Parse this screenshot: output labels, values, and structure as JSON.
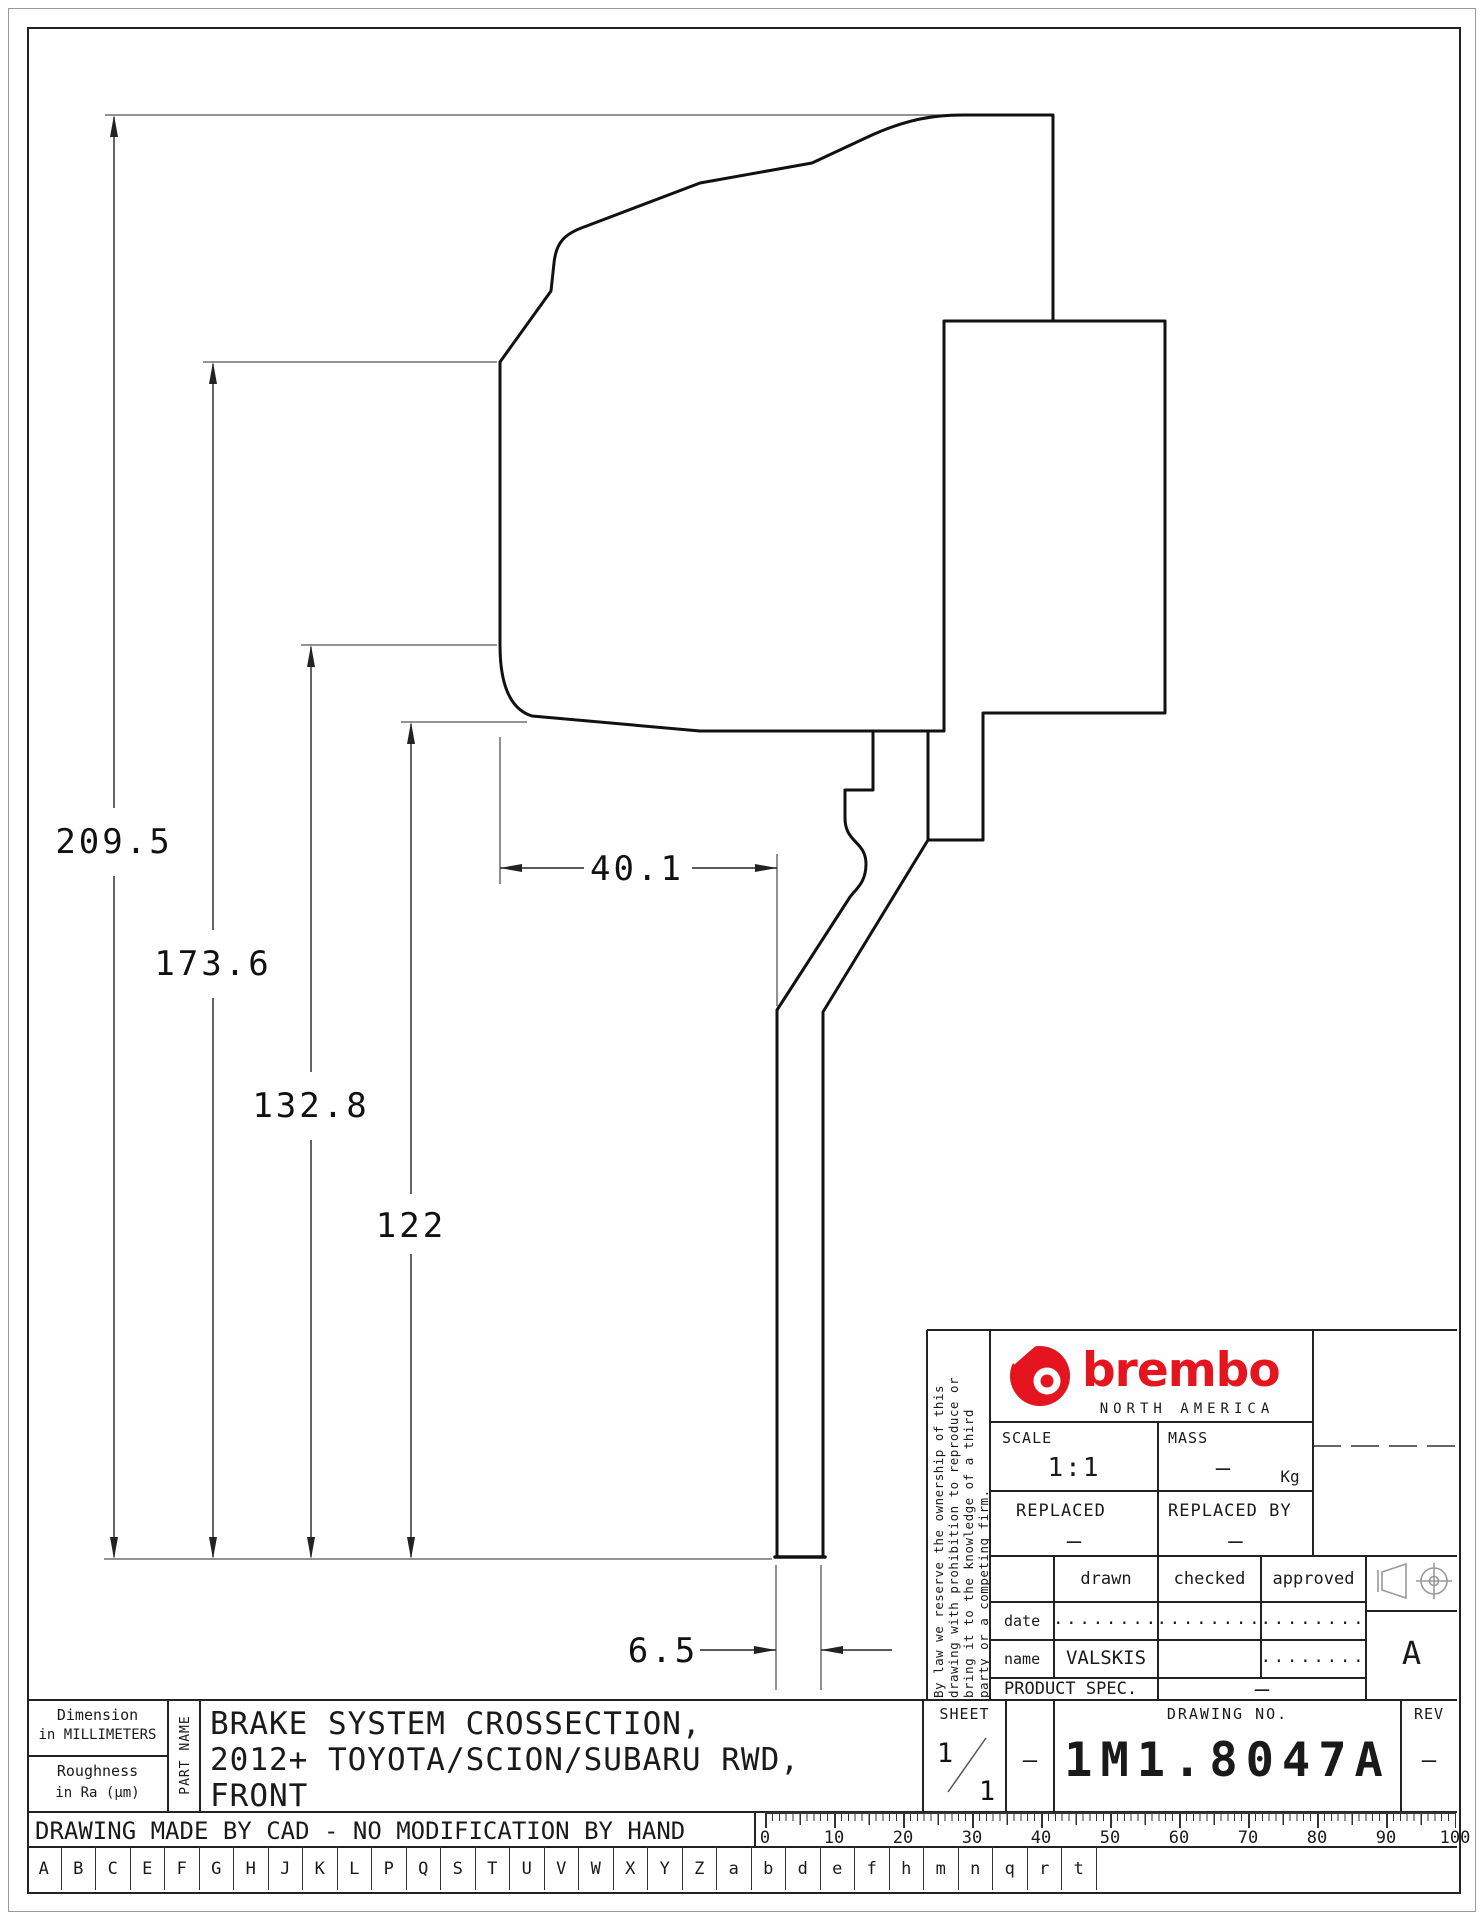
{
  "colors": {
    "line": "#1a1a1a",
    "thin": "#444444",
    "brand_red": "#e4151e"
  },
  "dimensions": {
    "radial": [
      {
        "label": "209.5"
      },
      {
        "label": "173.6"
      },
      {
        "label": "132.8"
      },
      {
        "label": "122"
      }
    ],
    "width": {
      "label": "40.1"
    },
    "thickness": {
      "label": "6.5"
    }
  },
  "title_block": {
    "ownership_lines": [
      "By law we reserve the ownership of this",
      "drawing with prohibition to reproduce or",
      "bring it to the knowledge of a third",
      "party or a competing firm."
    ],
    "brand": {
      "wordmark": "brembo",
      "region": "NORTH AMERICA"
    },
    "scale": {
      "label": "SCALE",
      "value": "1:1"
    },
    "mass": {
      "label": "MASS",
      "value": "–",
      "unit": "Kg"
    },
    "replaced": {
      "label": "REPLACED",
      "value": "–"
    },
    "replaced_by": {
      "label": "REPLACED BY",
      "value": "–"
    },
    "approvals": {
      "col_drawn": "drawn",
      "col_checked": "checked",
      "col_approved": "approved",
      "date_label": "date",
      "name_label": "name",
      "date_dots": "........",
      "name_value": "VALSKIS",
      "approved_name_dots": "........"
    },
    "product_spec": {
      "label": "PRODUCT SPEC.",
      "value": "–"
    },
    "format_letter": "A"
  },
  "bottom": {
    "dimension_note_1": "Dimension",
    "dimension_note_2": "in MILLIMETERS",
    "roughness_note_1": "Roughness",
    "roughness_note_2": "in Ra (μm)",
    "part_name_label": "PART NAME",
    "part_name_lines": [
      "BRAKE SYSTEM CROSSECTION,",
      "2012+ TOYOTA/SCION/SUBARU RWD,",
      "FRONT"
    ],
    "cad_note": "DRAWING MADE BY CAD - NO MODIFICATION BY HAND",
    "sheet": {
      "label": "SHEET",
      "numerator": "1",
      "denominator": "1",
      "dash": "–"
    },
    "drawing_no": {
      "label": "DRAWING NO.",
      "value": "1M1.8047A"
    },
    "rev": {
      "label": "REV",
      "value": "–"
    },
    "ruler_labels": [
      "0",
      "10",
      "20",
      "30",
      "40",
      "50",
      "60",
      "70",
      "80",
      "90",
      "100"
    ],
    "letters": [
      "A",
      "B",
      "C",
      "E",
      "F",
      "G",
      "H",
      "J",
      "K",
      "L",
      "P",
      "Q",
      "S",
      "T",
      "U",
      "V",
      "W",
      "X",
      "Y",
      "Z",
      "a",
      "b",
      "d",
      "e",
      "f",
      "h",
      "m",
      "n",
      "q",
      "r",
      "t"
    ]
  }
}
